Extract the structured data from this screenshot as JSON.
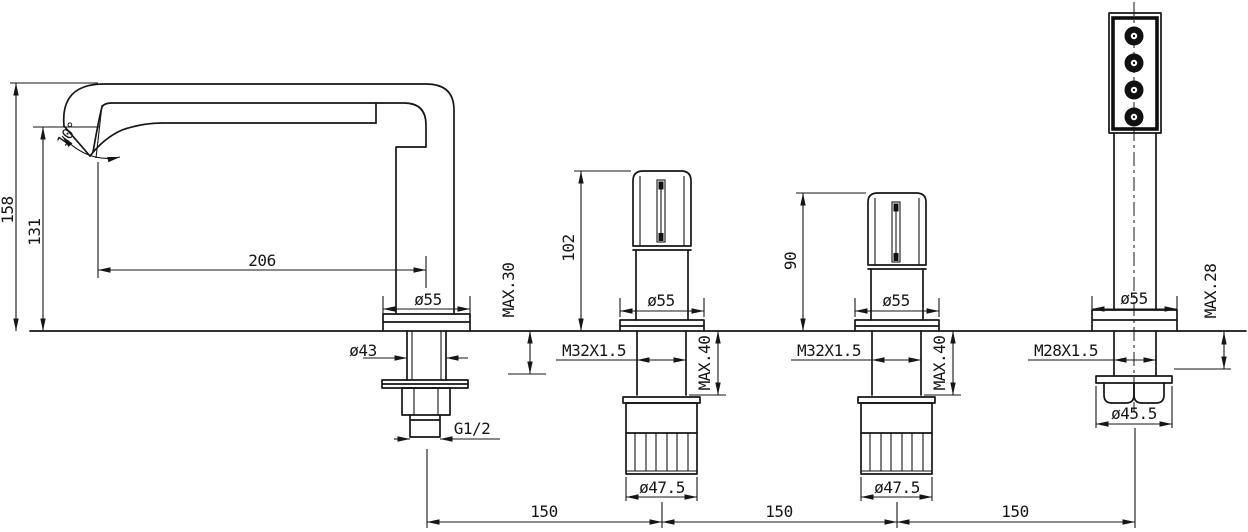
{
  "colors": {
    "line": "#161616",
    "background": "#ffffff"
  },
  "drawing": {
    "spout": {
      "total_height": "158",
      "spout_height": "131",
      "angle": "10°",
      "reach": "206",
      "base_diameter": "ø55",
      "shank_diameter": "ø43",
      "deck_max": "MAX.30",
      "outlet_thread": "G1/2"
    },
    "handle_left": {
      "height": "102",
      "base_diameter": "ø55",
      "thread": "M32X1.5",
      "deck_max": "MAX.40",
      "nut_diameter": "ø47.5"
    },
    "handle_right": {
      "height": "90",
      "base_diameter": "ø55",
      "thread": "M32X1.5",
      "deck_max": "MAX.40",
      "nut_diameter": "ø47.5"
    },
    "hand_shower": {
      "base_diameter": "ø55",
      "thread": "M28X1.5",
      "deck_max": "MAX.28",
      "nut_diameter": "ø45.5"
    },
    "spacing": {
      "left": "150",
      "middle": "150",
      "right": "150"
    }
  }
}
